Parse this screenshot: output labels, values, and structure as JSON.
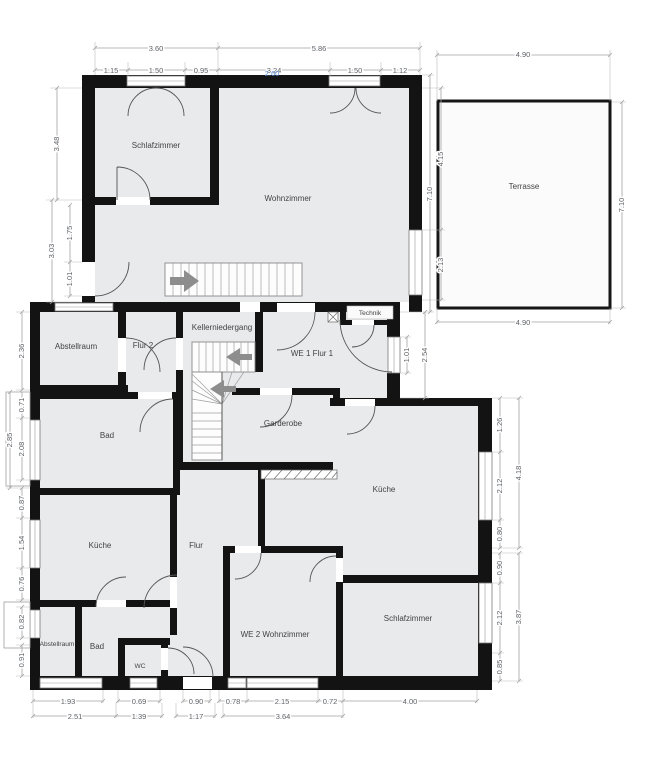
{
  "plan": {
    "rooms": {
      "schlafzimmer_og": "Schlafzimmer",
      "wohnzimmer": "Wohnzimmer",
      "terrasse": "Terrasse",
      "abstellraum_we1": "Abstellraum",
      "flur2": "Flur 2",
      "kellerniedergang": "Kellerniedergang",
      "we1_flur1": "WE 1 Flur 1",
      "technik": "Technik",
      "bad_we1": "Bad",
      "garderobe": "Garderobe",
      "kueche_we1": "Küche",
      "kueche_we2": "Küche",
      "flur": "Flur",
      "abstellraum_we2": "Abstellraum",
      "bad_we2": "Bad",
      "wc": "WC",
      "we2_wohnzimmer": "WE 2 Wohnzimmer",
      "schlafzimmer_we2": "Schlafzimmer"
    },
    "dims": {
      "top": {
        "schlaf_total": "3.60",
        "schlaf_a": "1.15",
        "schlaf_b": "1.50",
        "schlaf_c": "0.95",
        "wohn_total": "5.86",
        "wohn_a": "3.24",
        "wohn_b": "1.50",
        "wohn_c": "1.12",
        "selected": "2.60"
      },
      "terrasse": {
        "top": "4.90",
        "right": "7.10",
        "bottom": "4.90",
        "left": "7.10"
      },
      "right_upper": {
        "a": "4.15",
        "b": "2.13"
      },
      "right_mid": {
        "window": "1.01",
        "total": "2.54"
      },
      "right_kueche": {
        "a": "1.26",
        "b": "2.12",
        "c": "0.80",
        "total": "4.18"
      },
      "right_schlaf": {
        "a": "0.90",
        "b": "2.12",
        "c": "0.85",
        "total": "3.87"
      },
      "left": {
        "schlaf": "3.48",
        "a": "1.75",
        "b": "1.01",
        "total_a": "3.03",
        "abstell": "2.36",
        "bad_a": "0.71",
        "bad_b": "2.08",
        "bad_total": "2.85",
        "c": "0.87",
        "kueche_win": "1.54",
        "d": "0.76",
        "e": "0.82",
        "f": "0.91"
      },
      "bottom": {
        "r1_a": "1.93",
        "r1_b": "0.69",
        "r1_c": "0.90",
        "r1_d": "0.78",
        "r1_e": "2.15",
        "r1_f": "0.72",
        "r1_g": "4.00",
        "r2_a": "2.51",
        "r2_b": "1.39",
        "r2_c": "1.17",
        "r2_d": "3.64"
      }
    },
    "colors": {
      "wall": "#131313",
      "room_fill": "#e9eaec",
      "dim_line": "#a3a3a3",
      "dim_text": "#5f6368",
      "selected_dim": "#5b8fd9",
      "stair_arrow": "#8d8d8d"
    }
  }
}
